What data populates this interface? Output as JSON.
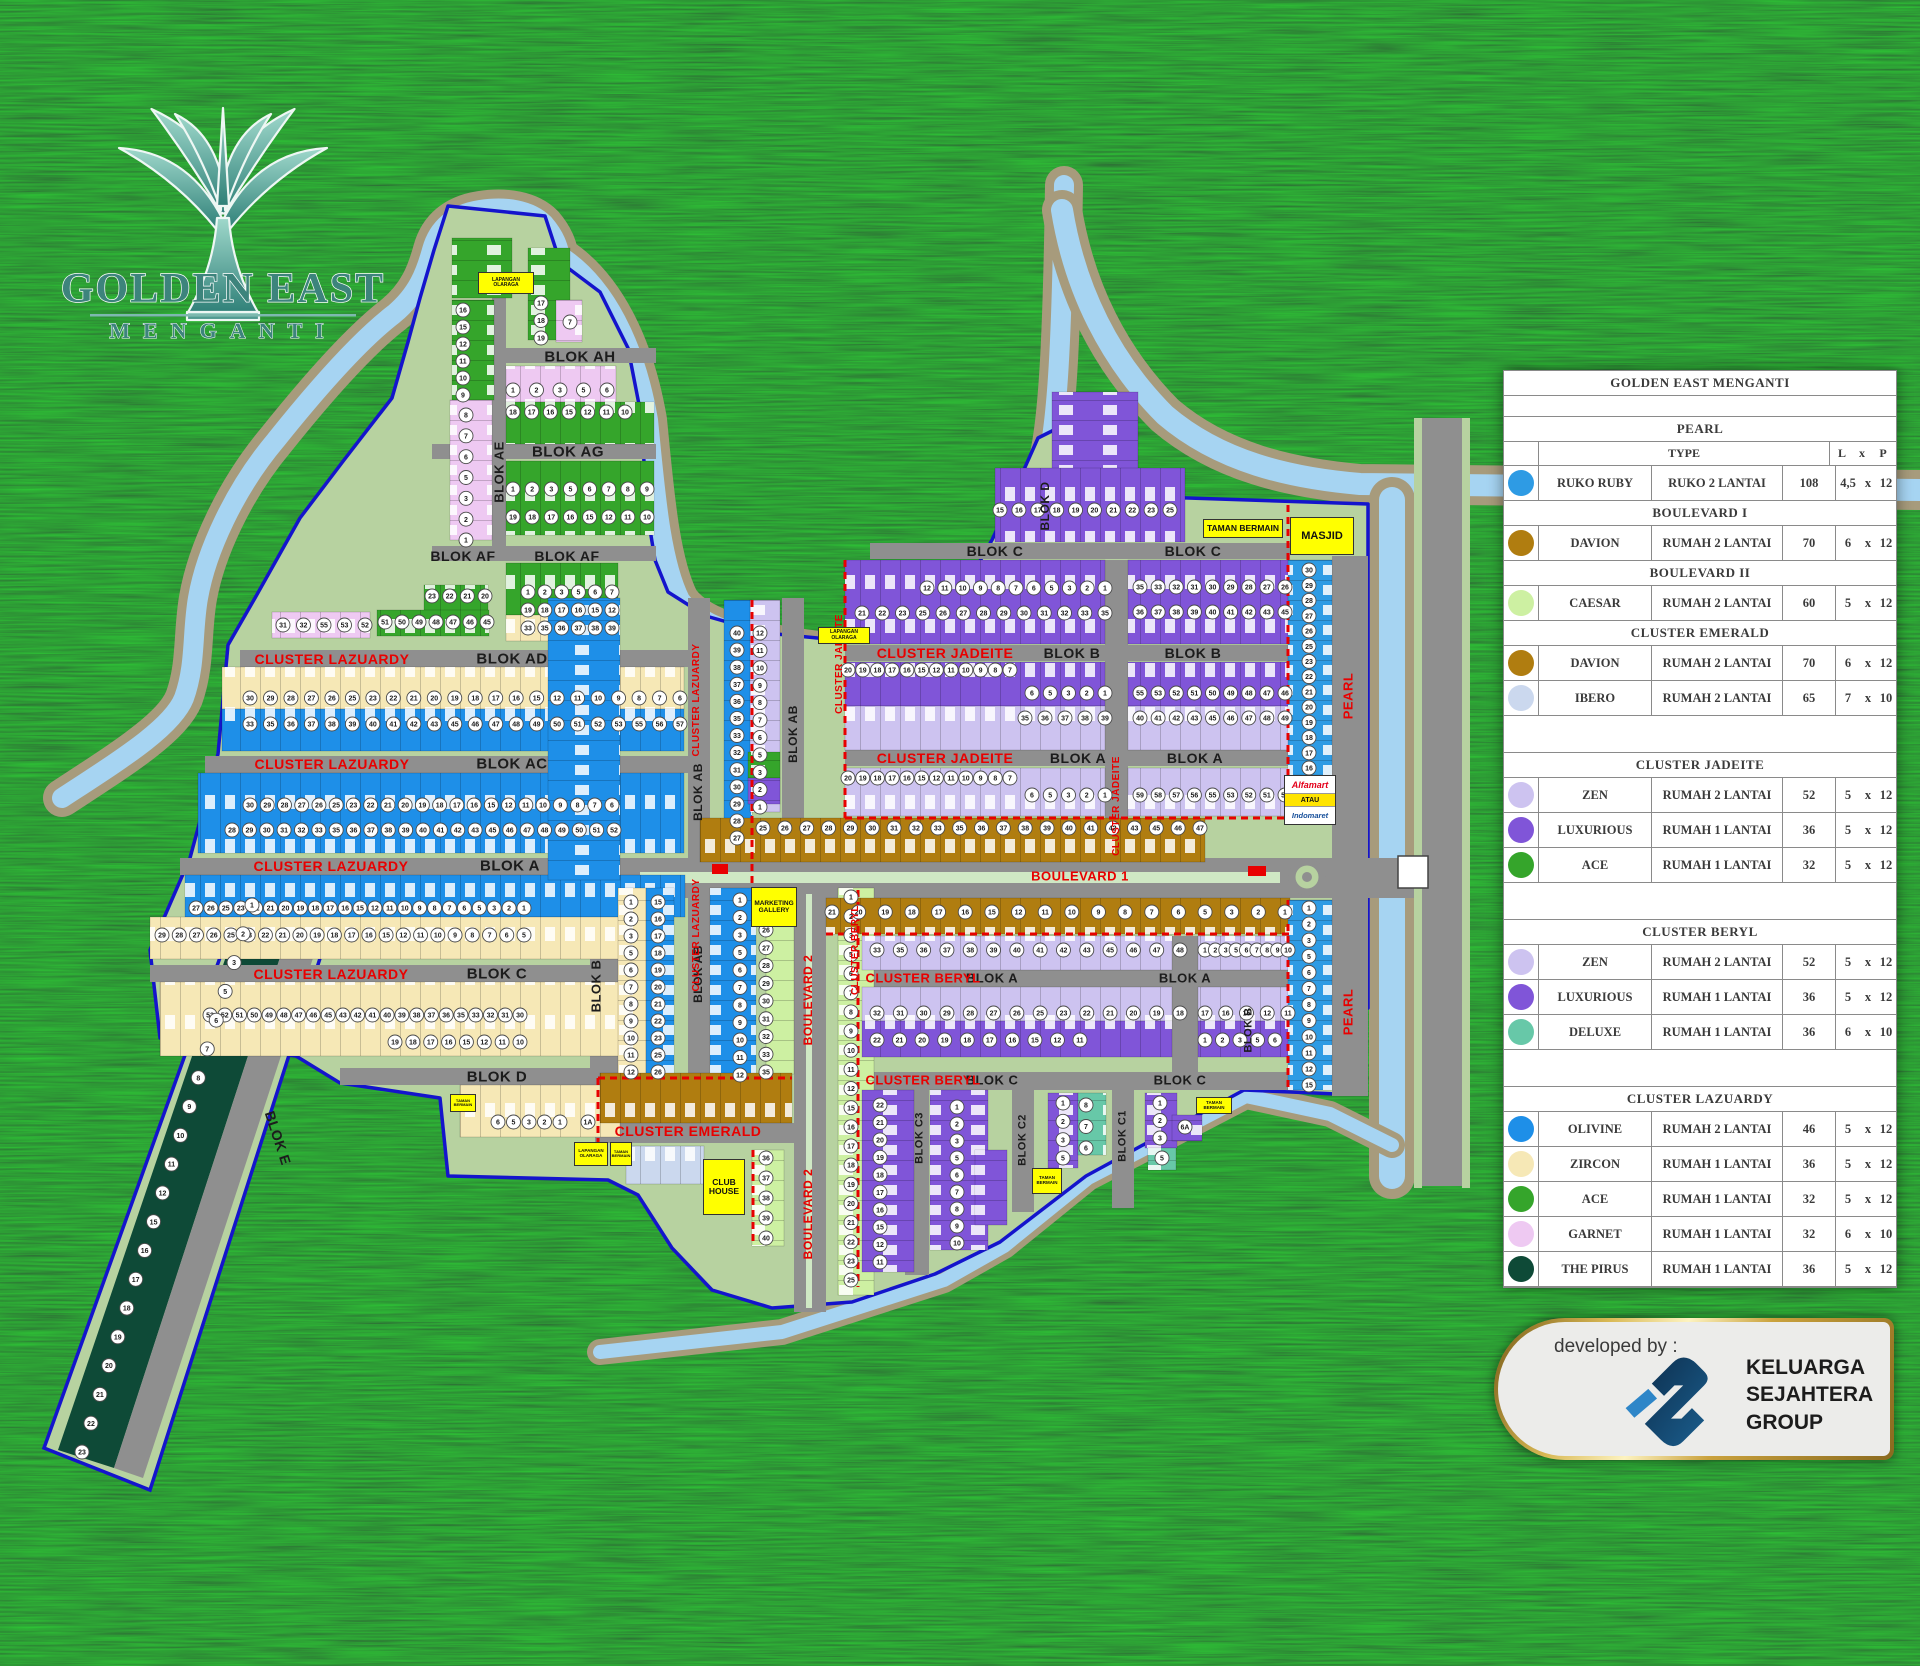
{
  "brand": {
    "title": "GOLDEN EAST",
    "subtitle": "MENGANTI"
  },
  "developer": {
    "prefix": "developed by :",
    "name_lines": [
      "KELUARGA",
      "SEJAHTERA",
      "GROUP"
    ]
  },
  "legend": {
    "title": "GOLDEN EAST MENGANTI",
    "col_headers": {
      "type": "TYPE",
      "l": "L",
      "x": "x",
      "p": "P"
    },
    "sections": [
      {
        "name": "PEARL",
        "type_header": true,
        "rows": [
          [
            "pearl",
            "RUKO RUBY",
            "RUKO 2 LANTAI",
            "108",
            "4,5",
            "12"
          ]
        ]
      },
      {
        "name": "BOULEVARD I",
        "rows": [
          [
            "davion",
            "DAVION",
            "RUMAH 2 LANTAI",
            "70",
            "6",
            "12"
          ]
        ]
      },
      {
        "name": "BOULEVARD II",
        "rows": [
          [
            "caesar",
            "CAESAR",
            "RUMAH 2 LANTAI",
            "60",
            "5",
            "12"
          ]
        ]
      },
      {
        "name": "CLUSTER EMERALD",
        "gap": true,
        "rows": [
          [
            "davion",
            "DAVION",
            "RUMAH 2 LANTAI",
            "70",
            "6",
            "12"
          ],
          [
            "ibero",
            "IBERO",
            "RUMAH 2 LANTAI",
            "65",
            "7",
            "10"
          ]
        ]
      },
      {
        "name": "CLUSTER JADEITE",
        "gap": true,
        "rows": [
          [
            "zen",
            "ZEN",
            "RUMAH 2 LANTAI",
            "52",
            "5",
            "12"
          ],
          [
            "luxurious",
            "LUXURIOUS",
            "RUMAH 1 LANTAI",
            "36",
            "5",
            "12"
          ],
          [
            "ace",
            "ACE",
            "RUMAH 1 LANTAI",
            "32",
            "5",
            "12"
          ]
        ]
      },
      {
        "name": "CLUSTER BERYL",
        "gap": true,
        "rows": [
          [
            "zen",
            "ZEN",
            "RUMAH 2 LANTAI",
            "52",
            "5",
            "12"
          ],
          [
            "luxurious",
            "LUXURIOUS",
            "RUMAH 1 LANTAI",
            "36",
            "5",
            "12"
          ],
          [
            "deluxe",
            "DELUXE",
            "RUMAH 1 LANTAI",
            "36",
            "6",
            "10"
          ]
        ]
      },
      {
        "name": "CLUSTER LAZUARDY",
        "rows": [
          [
            "olivine",
            "OLIVINE",
            "RUMAH 2 LANTAI",
            "46",
            "5",
            "12"
          ],
          [
            "zircon",
            "ZIRCON",
            "RUMAH 1 LANTAI",
            "36",
            "5",
            "12"
          ],
          [
            "ace",
            "ACE",
            "RUMAH 1 LANTAI",
            "32",
            "5",
            "12"
          ],
          [
            "garnet",
            "GARNET",
            "RUMAH 1 LANTAI",
            "32",
            "6",
            "10"
          ],
          [
            "pirus",
            "THE PIRUS",
            "RUMAH 1 LANTAI",
            "36",
            "5",
            "12"
          ]
        ]
      }
    ]
  },
  "map": {
    "colors": {
      "olivine": "#1E8FE8",
      "zircon": "#F6E8B6",
      "ace": "#35A52B",
      "garnet": "#EEC9F2",
      "pirus": "#0E4A37",
      "davion": "#B07D10",
      "caesar": "#CDF0A2",
      "ibero": "#CBD8EE",
      "zen": "#CDC3F0",
      "luxurious": "#8055D8",
      "deluxe": "#67C8A8",
      "pearl": "#2E9BE4",
      "site": "#B7D2A0",
      "road": "#8F8F8F",
      "water": "#A6D4F2",
      "bank": "#A79B7C",
      "outline": "#1414CC",
      "dash": "#E80000",
      "median": "#CFE8C4"
    },
    "labels": [
      [
        "BLOK AH",
        580,
        357,
        0,
        "b",
        15
      ],
      [
        "BLOK AG",
        568,
        452,
        0,
        "b",
        15
      ],
      [
        "BLOK AF",
        463,
        556,
        0,
        "b",
        14
      ],
      [
        "BLOK AF",
        567,
        556,
        0,
        "b",
        14
      ],
      [
        "BLOK AE",
        499,
        472,
        -90,
        "b",
        13
      ],
      [
        "BLOK AD",
        512,
        659,
        0,
        "b",
        15
      ],
      [
        "BLOK AC",
        512,
        764,
        0,
        "b",
        15
      ],
      [
        "BLOK A",
        510,
        866,
        0,
        "b",
        15
      ],
      [
        "BLOK C",
        497,
        974,
        0,
        "b",
        15
      ],
      [
        "BLOK D",
        497,
        1077,
        0,
        "b",
        15
      ],
      [
        "BLOK B",
        596,
        986,
        -90,
        "b",
        13
      ],
      [
        "BLOK AB",
        698,
        792,
        -90,
        "b",
        12
      ],
      [
        "BLOK AB",
        793,
        734,
        -90,
        "b",
        12
      ],
      [
        "BLOK AB",
        698,
        974,
        -90,
        "b",
        12
      ],
      [
        "BLOK E",
        278,
        1138,
        72,
        "b",
        14
      ],
      [
        "BLOK D",
        1045,
        506,
        -90,
        "b",
        12
      ],
      [
        "BLOK C",
        995,
        551,
        0,
        "b",
        14
      ],
      [
        "BLOK C",
        1193,
        551,
        0,
        "b",
        14
      ],
      [
        "BLOK B",
        1072,
        653,
        0,
        "b",
        14
      ],
      [
        "BLOK B",
        1193,
        653,
        0,
        "b",
        14
      ],
      [
        "BLOK A",
        1078,
        758,
        0,
        "b",
        14
      ],
      [
        "BLOK A",
        1195,
        758,
        0,
        "b",
        14
      ],
      [
        "BLOK A",
        992,
        978,
        0,
        "b",
        13
      ],
      [
        "BLOK A",
        1185,
        978,
        0,
        "b",
        13
      ],
      [
        "BLOK C",
        992,
        1080,
        0,
        "b",
        13
      ],
      [
        "BLOK C",
        1180,
        1080,
        0,
        "b",
        13
      ],
      [
        "BLOK C3",
        920,
        1138,
        -90,
        "b",
        11
      ],
      [
        "BLOK C2",
        1023,
        1140,
        -90,
        "b",
        11
      ],
      [
        "BLOK C1",
        1123,
        1136,
        -90,
        "b",
        11
      ],
      [
        "BLOK B",
        1249,
        1030,
        -90,
        "b",
        11
      ],
      [
        "CLUSTER LAZUARDY",
        332,
        659,
        0,
        "r",
        14
      ],
      [
        "CLUSTER LAZUARDY",
        332,
        764,
        0,
        "r",
        14
      ],
      [
        "CLUSTER LAZUARDY",
        331,
        866,
        0,
        "r",
        14
      ],
      [
        "CLUSTER LAZUARDY",
        331,
        974,
        0,
        "r",
        14
      ],
      [
        "CLUSTER LAZUARDY",
        697,
        700,
        -90,
        "r",
        10
      ],
      [
        "CLUSTER LAZUARDY",
        697,
        935,
        -90,
        "r",
        10
      ],
      [
        "CLUSTER JADEITE",
        945,
        653,
        0,
        "r",
        14
      ],
      [
        "CLUSTER JADEITE",
        945,
        758,
        0,
        "r",
        14
      ],
      [
        "CLUSTER JADEITE",
        1117,
        806,
        -90,
        "r",
        10
      ],
      [
        "CLUSTER JADEITE",
        840,
        664,
        -90,
        "r",
        10
      ],
      [
        "CLUSTER BERYL",
        923,
        978,
        0,
        "r",
        13
      ],
      [
        "CLUSTER BERYL",
        923,
        1080,
        0,
        "r",
        13
      ],
      [
        "CLUSTER BERYL",
        856,
        950,
        -90,
        "r",
        10
      ],
      [
        "CLUSTER EMERALD",
        688,
        1131,
        0,
        "r",
        14
      ],
      [
        "BOULEVARD 1",
        1080,
        876,
        0,
        "r",
        13
      ],
      [
        "BOULEVARD 2",
        808,
        1000,
        -90,
        "r",
        12
      ],
      [
        "BOULEVARD 2",
        808,
        1214,
        -90,
        "r",
        12
      ],
      [
        "PEARL",
        1348,
        696,
        -90,
        "r",
        13
      ],
      [
        "PEARL",
        1348,
        1012,
        -90,
        "r",
        13
      ]
    ],
    "facilities": [
      [
        "LAPANGAN OLARAGA",
        478,
        272,
        56,
        22,
        5
      ],
      [
        "LAPANGAN OLARAGA",
        818,
        627,
        52,
        17,
        5
      ],
      [
        "LAPANGAN OLARAGA",
        574,
        1142,
        34,
        24,
        4.5
      ],
      [
        "TAMAN BERMAIN",
        1203,
        519,
        80,
        19,
        8.5
      ],
      [
        "TAMAN BERMAIN",
        610,
        1142,
        22,
        24,
        4
      ],
      [
        "TAMAN BERMAIN",
        1032,
        1168,
        30,
        26,
        4.5
      ],
      [
        "TAMAN BERMAIN",
        1196,
        1097,
        36,
        17,
        4.5
      ],
      [
        "TAMAN BERMAIN",
        450,
        1094,
        26,
        18,
        4
      ],
      [
        "MASJID",
        1290,
        517,
        64,
        38,
        11
      ],
      [
        "MARKETING GALLERY",
        751,
        887,
        46,
        40,
        6.5
      ],
      [
        "CLUB HOUSE",
        703,
        1159,
        42,
        56,
        8.5
      ]
    ],
    "alfamart": {
      "line1": "Alfamart",
      "line2": "ATAU",
      "line3": "Indomaret",
      "x": 1284,
      "y": 775,
      "w": 52,
      "h": 50
    },
    "lot_rows": [
      {
        "a": 463,
        "b": 310,
        "c": 463,
        "d": 395,
        "f": 16,
        "t": 9
      },
      {
        "a": 466,
        "b": 415,
        "c": 466,
        "d": 540,
        "f": 8,
        "t": 1
      },
      {
        "a": 541,
        "b": 303,
        "c": 541,
        "d": 338,
        "f": 17,
        "t": 19
      },
      {
        "a": 570,
        "b": 322,
        "c": 570,
        "d": 322,
        "L": [
          "7"
        ]
      },
      {
        "a": 513,
        "b": 390,
        "c": 607,
        "d": 390,
        "f": 1,
        "t": 6
      },
      {
        "a": 513,
        "b": 412,
        "c": 625,
        "d": 412,
        "f": 18,
        "t": 10
      },
      {
        "a": 513,
        "b": 489,
        "c": 647,
        "d": 489,
        "f": 1,
        "t": 9
      },
      {
        "a": 513,
        "b": 517,
        "c": 647,
        "d": 517,
        "f": 19,
        "t": 10
      },
      {
        "a": 528,
        "b": 592,
        "c": 612,
        "d": 592,
        "f": 1,
        "t": 7
      },
      {
        "a": 528,
        "b": 610,
        "c": 612,
        "d": 610,
        "f": 19,
        "t": 12
      },
      {
        "a": 528,
        "b": 628,
        "c": 612,
        "d": 628,
        "f": 33,
        "t": 39
      },
      {
        "a": 432,
        "b": 596,
        "c": 485,
        "d": 596,
        "f": 23,
        "t": 20
      },
      {
        "a": 385,
        "b": 622,
        "c": 487,
        "d": 622,
        "f": 51,
        "t": 45
      },
      {
        "a": 283,
        "b": 625,
        "c": 365,
        "d": 625,
        "L": [
          31,
          32,
          55,
          53,
          52
        ]
      },
      {
        "a": 250,
        "b": 698,
        "c": 680,
        "d": 698,
        "f": 30,
        "t": 6
      },
      {
        "a": 250,
        "b": 724,
        "c": 680,
        "d": 724,
        "f": 33,
        "t": 57
      },
      {
        "a": 250,
        "b": 805,
        "c": 612,
        "d": 805,
        "f": 30,
        "t": 6
      },
      {
        "a": 232,
        "b": 830,
        "c": 614,
        "d": 830,
        "f": 28,
        "t": 52
      },
      {
        "a": 196,
        "b": 908,
        "c": 524,
        "d": 908,
        "f": 27,
        "t": 1
      },
      {
        "a": 162,
        "b": 935,
        "c": 524,
        "d": 935,
        "f": 29,
        "t": 5
      },
      {
        "a": 210,
        "b": 1015,
        "c": 520,
        "d": 1015,
        "f": 53,
        "t": 30
      },
      {
        "a": 395,
        "b": 1042,
        "c": 520,
        "d": 1042,
        "f": 19,
        "t": 10
      },
      {
        "a": 498,
        "b": 1122,
        "c": 560,
        "d": 1122,
        "f": 6,
        "t": 1
      },
      {
        "a": 588,
        "b": 1122,
        "c": 588,
        "d": 1122,
        "L": [
          "1A"
        ]
      },
      {
        "a": 631,
        "b": 902,
        "c": 631,
        "d": 1072,
        "f": 1,
        "t": 12
      },
      {
        "a": 658,
        "b": 902,
        "c": 658,
        "d": 1072,
        "f": 15,
        "t": 26
      },
      {
        "a": 740,
        "b": 900,
        "c": 740,
        "d": 1075,
        "f": 1,
        "t": 12
      },
      {
        "a": 766,
        "b": 930,
        "c": 766,
        "d": 1072,
        "f": 26,
        "t": 35
      },
      {
        "a": 766,
        "b": 1158,
        "c": 766,
        "d": 1238,
        "f": 36,
        "t": 40
      },
      {
        "a": 851,
        "b": 897,
        "c": 851,
        "d": 1280,
        "f": 1,
        "t": 25
      },
      {
        "a": 737,
        "b": 633,
        "c": 737,
        "d": 838,
        "f": 40,
        "t": 27
      },
      {
        "a": 760,
        "b": 633,
        "c": 760,
        "d": 807,
        "f": 12,
        "t": 1
      },
      {
        "a": 1000,
        "b": 510,
        "c": 1170,
        "d": 510,
        "f": 15,
        "t": 25
      },
      {
        "a": 1140,
        "b": 587,
        "c": 1285,
        "d": 587,
        "f": 35,
        "t": 26
      },
      {
        "a": 1140,
        "b": 612,
        "c": 1285,
        "d": 612,
        "f": 36,
        "t": 45
      },
      {
        "a": 927,
        "b": 588,
        "c": 1105,
        "d": 588,
        "f": 12,
        "t": 1
      },
      {
        "a": 862,
        "b": 613,
        "c": 1105,
        "d": 613,
        "f": 21,
        "t": 35
      },
      {
        "a": 1032,
        "b": 693,
        "c": 1105,
        "d": 693,
        "f": 6,
        "t": 1
      },
      {
        "a": 1025,
        "b": 718,
        "c": 1105,
        "d": 718,
        "L": [
          35,
          36,
          37,
          38,
          39
        ]
      },
      {
        "a": 1140,
        "b": 693,
        "c": 1285,
        "d": 693,
        "f": 55,
        "t": 46
      },
      {
        "a": 1140,
        "b": 718,
        "c": 1285,
        "d": 718,
        "f": 40,
        "t": 49
      },
      {
        "a": 848,
        "b": 670,
        "c": 1010,
        "d": 670,
        "f": 20,
        "t": 7
      },
      {
        "a": 1032,
        "b": 795,
        "c": 1105,
        "d": 795,
        "f": 6,
        "t": 1
      },
      {
        "a": 1140,
        "b": 795,
        "c": 1285,
        "d": 795,
        "f": 59,
        "t": 50
      },
      {
        "a": 848,
        "b": 778,
        "c": 1010,
        "d": 778,
        "f": 20,
        "t": 7
      },
      {
        "a": 763,
        "b": 828,
        "c": 1200,
        "d": 828,
        "f": 25,
        "t": 47
      },
      {
        "a": 832,
        "b": 912,
        "c": 1285,
        "d": 912,
        "f": 21,
        "t": 1
      },
      {
        "a": 877,
        "b": 950,
        "c": 1180,
        "d": 950,
        "f": 33,
        "t": 48
      },
      {
        "a": 1205,
        "b": 950,
        "c": 1288,
        "d": 950,
        "f": 1,
        "t": 10
      },
      {
        "a": 877,
        "b": 1013,
        "c": 1180,
        "d": 1013,
        "f": 32,
        "t": 18
      },
      {
        "a": 1205,
        "b": 1013,
        "c": 1288,
        "d": 1013,
        "f": 17,
        "t": 11
      },
      {
        "a": 877,
        "b": 1040,
        "c": 1080,
        "d": 1040,
        "f": 22,
        "t": 11
      },
      {
        "a": 1205,
        "b": 1040,
        "c": 1275,
        "d": 1040,
        "f": 1,
        "t": 6
      },
      {
        "a": 880,
        "b": 1105,
        "c": 880,
        "d": 1262,
        "f": 22,
        "t": 11
      },
      {
        "a": 957,
        "b": 1107,
        "c": 957,
        "d": 1243,
        "f": 1,
        "t": 10
      },
      {
        "a": 1063,
        "b": 1103,
        "c": 1063,
        "d": 1158,
        "f": 1,
        "t": 5
      },
      {
        "a": 1086,
        "b": 1105,
        "c": 1086,
        "d": 1148,
        "f": 8,
        "t": 6
      },
      {
        "a": 1160,
        "b": 1103,
        "c": 1160,
        "d": 1138,
        "f": 1,
        "t": 3
      },
      {
        "a": 1185,
        "b": 1127,
        "c": 1185,
        "d": 1127,
        "L": [
          "6A"
        ]
      },
      {
        "a": 1162,
        "b": 1158,
        "c": 1162,
        "d": 1158,
        "L": [
          "5"
        ]
      },
      {
        "a": 1309,
        "b": 570,
        "c": 1309,
        "d": 768,
        "f": 30,
        "t": 16
      },
      {
        "a": 1309,
        "b": 908,
        "c": 1309,
        "d": 1085,
        "f": 1,
        "t": 15
      },
      {
        "a": 252,
        "b": 905,
        "c": 82,
        "d": 1452,
        "f": 1,
        "t": 23
      }
    ]
  }
}
